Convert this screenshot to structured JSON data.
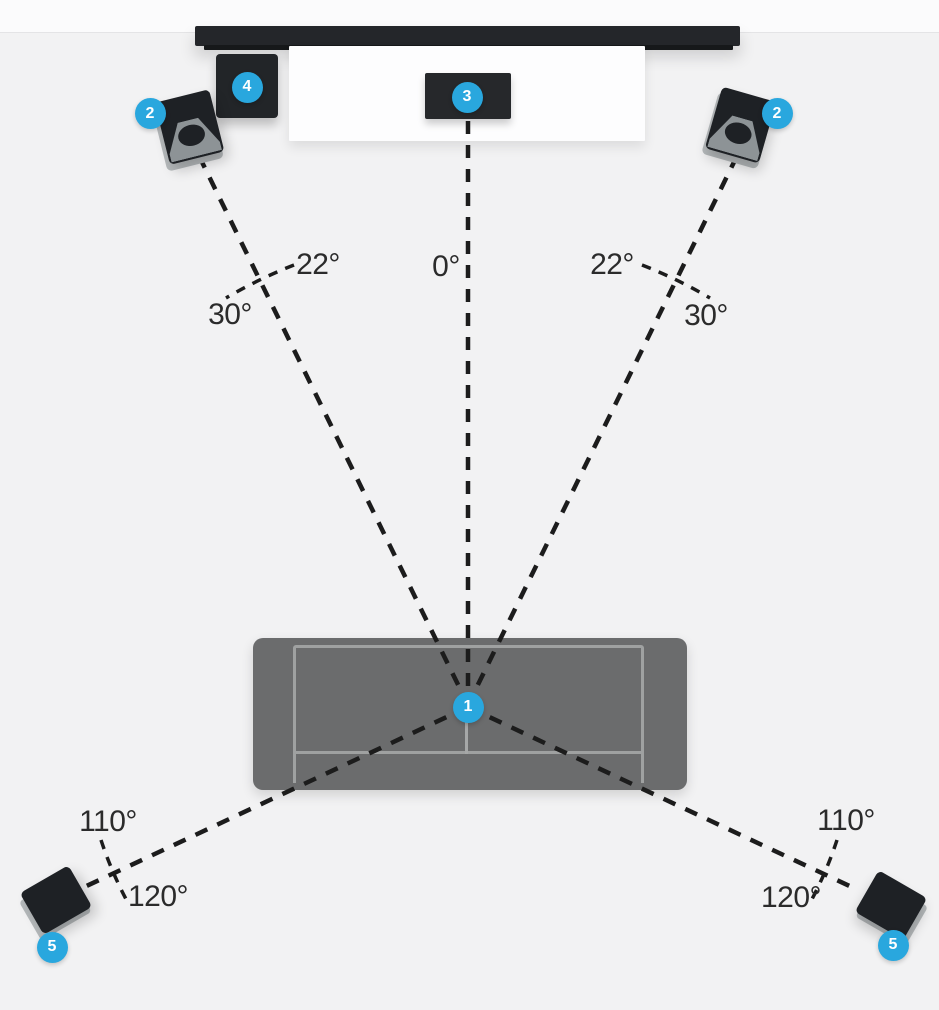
{
  "badges": {
    "listener": "1",
    "front_left": "2",
    "front_right": "2",
    "center_channel": "3",
    "subwoofer": "4",
    "surround_left": "5",
    "surround_right": "5"
  },
  "angles": {
    "center": "0°",
    "front_left": [
      "22°",
      "30°"
    ],
    "front_right": [
      "22°",
      "30°"
    ],
    "surround_left": [
      "110°",
      "120°"
    ],
    "surround_right": [
      "110°",
      "120°"
    ]
  },
  "colors": {
    "badge_blue": "#29a7de",
    "dash_black": "#1c1c1c",
    "couch_gray": "#6b6c6d",
    "speaker_dark": "#1e2125",
    "background": "#f2f2f3"
  }
}
